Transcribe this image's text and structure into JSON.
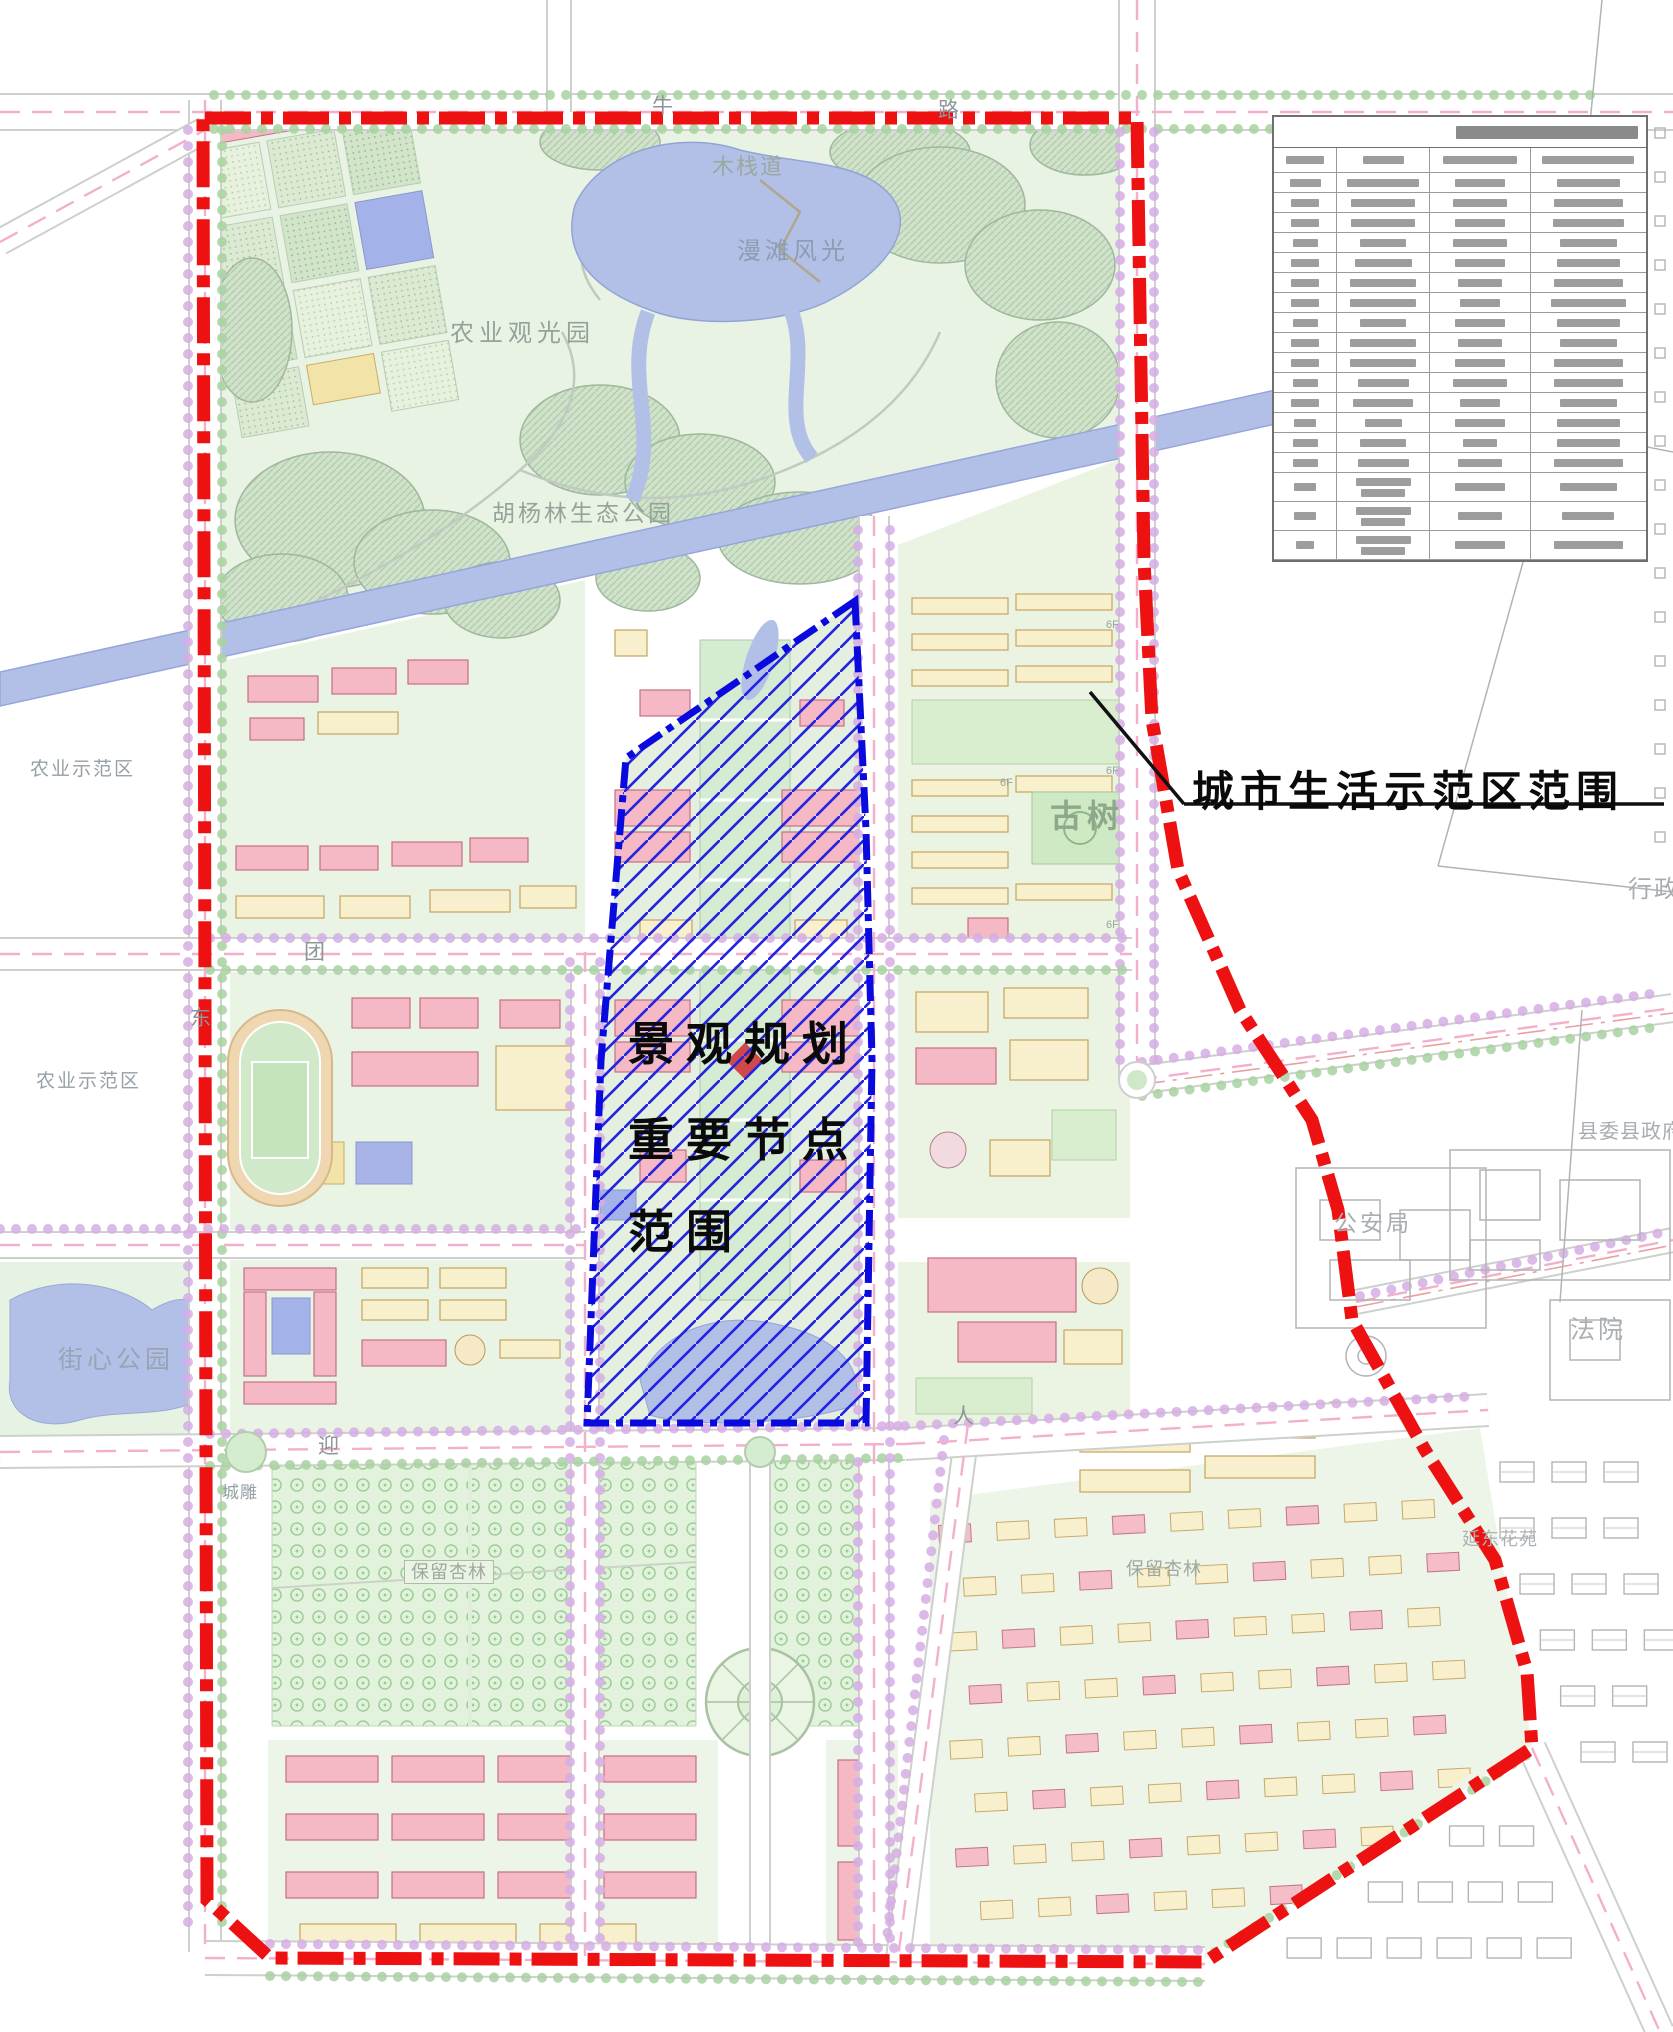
{
  "annotations": {
    "boundary_label": "城市生活示范区范围",
    "node_label_lines": [
      "景观规划",
      "重要节点",
      "范围"
    ]
  },
  "map_labels": {
    "lake": "漫滩风光",
    "agri_park": "农业观光园",
    "poplar_park": "胡杨林生态公园",
    "boardwalk": "木栈道",
    "old_tree": "古树",
    "agri_demo_1": "农业示范区",
    "agri_demo_2": "农业示范区",
    "street_park": "街心公园",
    "police": "公安局",
    "court": "法院",
    "county_gov": "县委县政府",
    "admin": "行政",
    "residence": "延东花苑",
    "orchard_1": "保留杏林",
    "orchard_2": "保留杏林",
    "sculpture": "城雕"
  },
  "road_chars": [
    {
      "ch": "牛",
      "x": 652,
      "y": 96
    },
    {
      "ch": "路",
      "x": 938,
      "y": 100
    },
    {
      "ch": "团",
      "x": 304,
      "y": 942
    },
    {
      "ch": "东",
      "x": 190,
      "y": 1008
    },
    {
      "ch": "迎",
      "x": 318,
      "y": 1436
    },
    {
      "ch": "人",
      "x": 953,
      "y": 1406
    }
  ],
  "floor_tags": [
    {
      "t": "6F",
      "x": 1106,
      "y": 620
    },
    {
      "t": "6F",
      "x": 1106,
      "y": 766
    },
    {
      "t": "6F",
      "x": 1106,
      "y": 920
    },
    {
      "t": "6F",
      "x": 1000,
      "y": 778
    }
  ],
  "legend_table": {
    "illegible": true,
    "columns": 4,
    "col_widths": [
      0.17,
      0.25,
      0.27,
      0.31
    ],
    "title_bar": 0.5,
    "header_bars": [
      0.6,
      0.45,
      0.75,
      0.8
    ],
    "rows": [
      [
        0.5,
        0.78,
        0.5,
        0.55
      ],
      [
        0.45,
        0.7,
        0.55,
        0.6
      ],
      [
        0.45,
        0.7,
        0.5,
        0.62
      ],
      [
        0.4,
        0.5,
        0.55,
        0.5
      ],
      [
        0.45,
        0.62,
        0.5,
        0.55
      ],
      [
        0.45,
        0.72,
        0.45,
        0.6
      ],
      [
        0.45,
        0.72,
        0.4,
        0.65
      ],
      [
        0.4,
        0.5,
        0.5,
        0.55
      ],
      [
        0.45,
        0.72,
        0.45,
        0.5
      ],
      [
        0.45,
        0.72,
        0.5,
        0.6
      ],
      [
        0.4,
        0.55,
        0.55,
        0.6
      ],
      [
        0.45,
        0.65,
        0.4,
        0.5
      ],
      [
        0.35,
        0.4,
        0.5,
        0.55
      ],
      [
        0.4,
        0.5,
        0.35,
        0.55
      ],
      [
        0.4,
        0.55,
        0.45,
        0.6
      ],
      [
        0.35,
        0.6,
        0.5,
        0.5
      ],
      [
        0.35,
        0.6,
        0.45,
        0.45
      ],
      [
        0.3,
        0.6,
        0.5,
        0.6
      ]
    ],
    "tall_from": 15
  },
  "colors": {
    "boundary_red": "#ee1111",
    "node_blue": "#0a0adf",
    "water": "#b2c0e8",
    "park_green": "#e8f3e4",
    "tree_mass": "#cfe2ca",
    "building_pink": "#f5b9c5",
    "building_cream": "#f8efcd",
    "tree_dot_violet": "#d6aee4",
    "tree_dot_green": "#a9d3a0",
    "road_dash_pink": "#f3b0cb",
    "cad_gray": "#b3b3b3"
  }
}
